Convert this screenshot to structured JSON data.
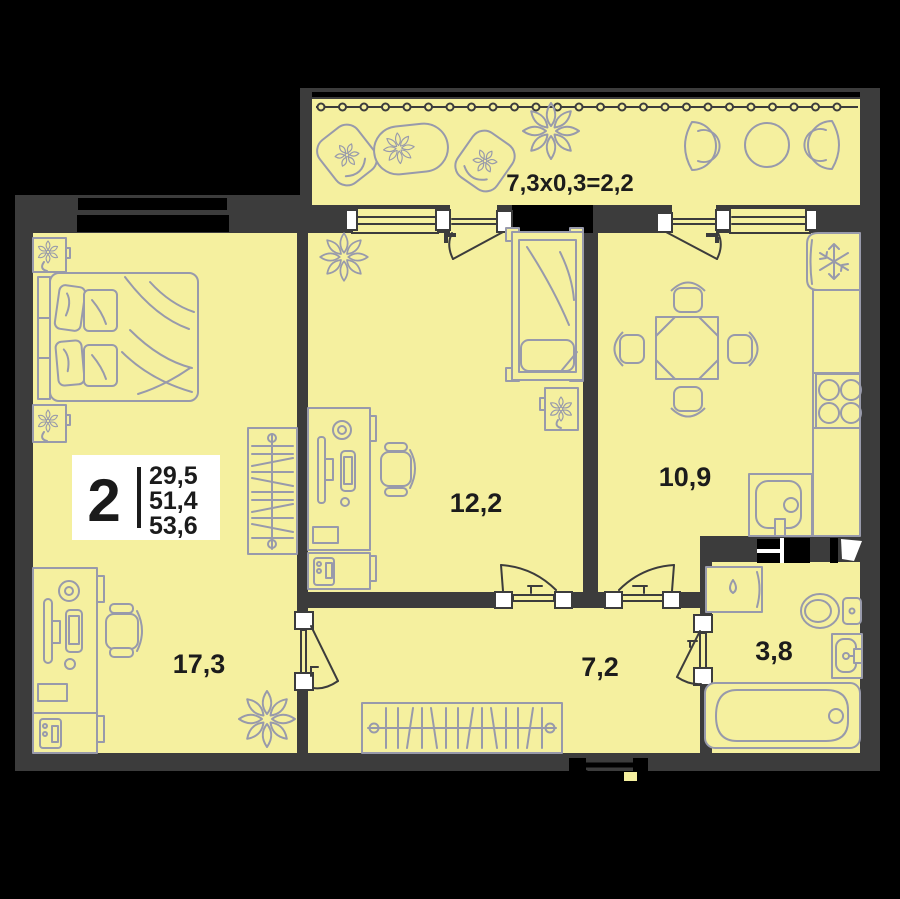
{
  "plan": {
    "badge": {
      "rooms_count": "2",
      "area_lines": [
        "29,5",
        "51,4",
        "53,6"
      ]
    },
    "balcony": {
      "formula": "7,3х0,3=2,2"
    },
    "rooms": [
      {
        "name": "living-room",
        "area": "17,3"
      },
      {
        "name": "bedroom",
        "area": "12,2"
      },
      {
        "name": "kitchen",
        "area": "10,9"
      },
      {
        "name": "hallway",
        "area": "7,2"
      },
      {
        "name": "bathroom",
        "area": "3,8"
      }
    ],
    "colors": {
      "background": "#000000",
      "wall": "#3c3c3c",
      "floor": "#f5f09f",
      "furniture": "#989aab",
      "label_text": "#1c1c1c",
      "badge_bg": "#ffffff"
    }
  }
}
